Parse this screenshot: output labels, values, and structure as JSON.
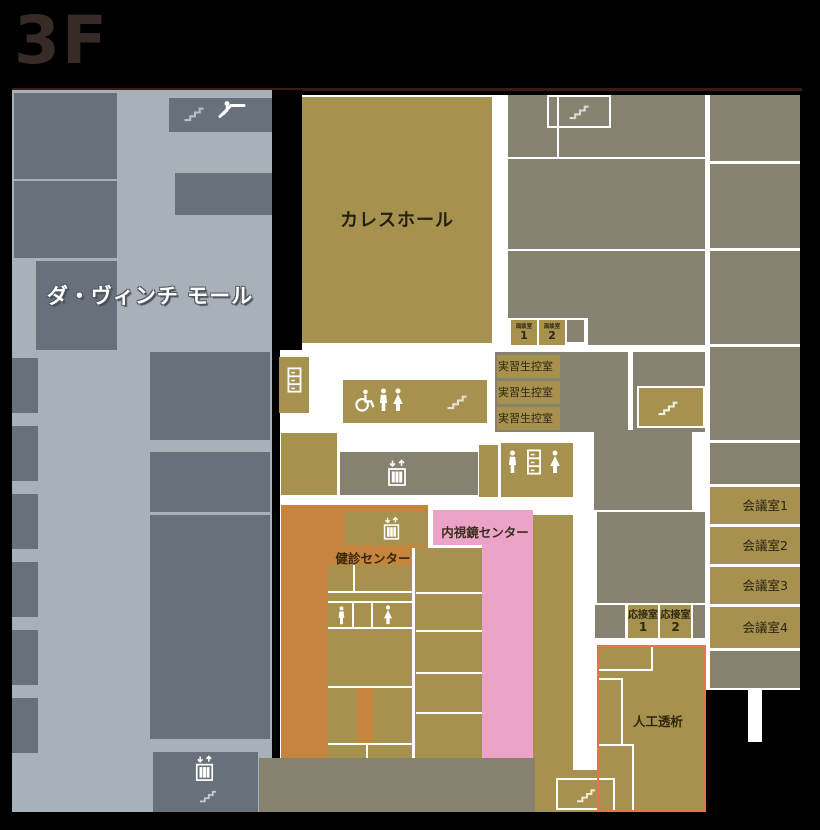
{
  "title": "3F",
  "mall": {
    "label": "ダ・ヴィンチ モール"
  },
  "rooms": {
    "caress_hall": "カレスホール",
    "interview_room": {
      "label": "面談室",
      "num1": "1",
      "num2": "2"
    },
    "trainee_room": "実習生控室",
    "meeting_rooms": [
      "会議室1",
      "会議室2",
      "会議室3",
      "会議室4"
    ],
    "reception_room": {
      "label": "応接室",
      "num1": "1",
      "num2": "2"
    },
    "checkup_center": "健診センター",
    "endoscopy_center": "内視鏡センター",
    "dialysis": "人工透析"
  },
  "icons": {
    "stairs": "stairs-icon",
    "escalator": "escalator-icon",
    "elevator": "elevator-icon",
    "toilet_man": "man-icon",
    "toilet_woman": "woman-icon",
    "wheelchair": "wheelchair-icon",
    "locker": "locker-icon"
  },
  "colors": {
    "room_gold": "#a6914e",
    "room_gray": "#87826f",
    "mall_shop_gray": "#68717b",
    "mall_corridor": "#a9b1b8",
    "checkup_orange": "#c5853e",
    "endoscopy_pink": "#eba4c7",
    "dialysis_border": "#e0764b",
    "background": "#000000"
  }
}
